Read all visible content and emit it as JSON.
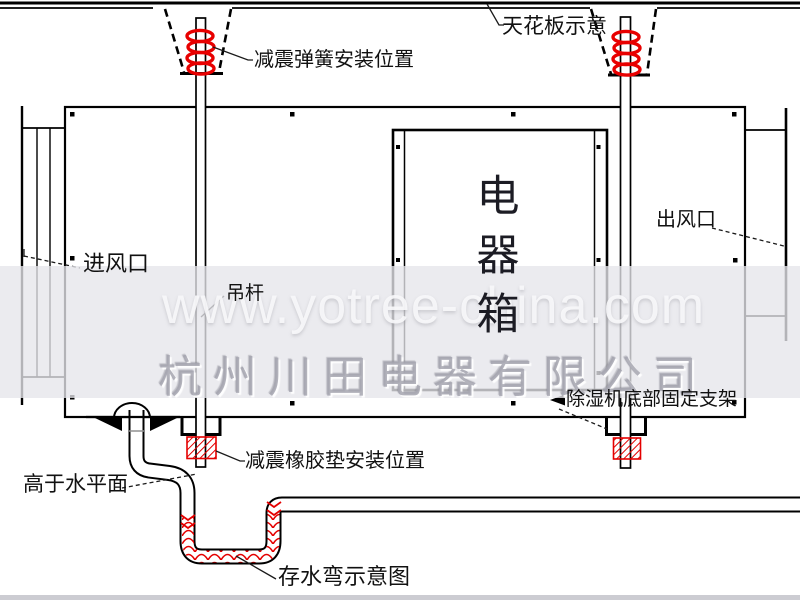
{
  "diagram": {
    "title_semantic": "ceiling-mounted dehumidifier installation schematic",
    "labels": {
      "ceiling": "天花板示意",
      "spring": "减震弹簧安装位置",
      "inlet": "进风口",
      "hanger_rod": "吊杆",
      "electric_box": "电器箱",
      "outlet": "出风口",
      "bottom_bracket": "除湿机底部固定支架",
      "rubber_pad": "减震橡胶垫安装位置",
      "above_water_level": "高于水平面",
      "water_trap": "存水弯示意图"
    },
    "electric_box_chars": [
      "电",
      "器",
      "箱"
    ],
    "colors": {
      "line": "#000000",
      "highlight_red": "#e40000",
      "watermark_band": "#e5e5eb"
    }
  },
  "watermark": {
    "url": "www.yotree-china.com",
    "company": "杭州川田电器有限公司"
  }
}
